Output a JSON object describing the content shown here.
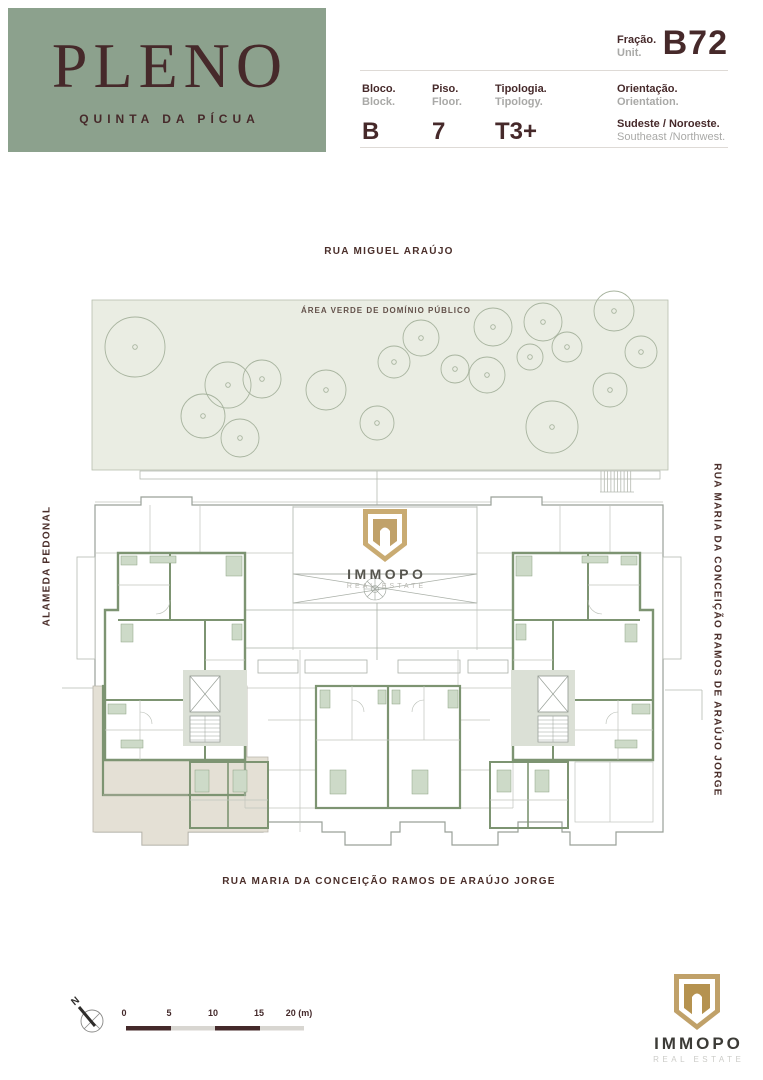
{
  "brand": {
    "name": "PLENO",
    "subtitle": "QUINTA DA PÍCUA"
  },
  "unit_info": {
    "fraction_label_pt": "Fração.",
    "fraction_label_en": "Unit.",
    "fraction_value": "B72",
    "fields": [
      {
        "label_pt": "Bloco.",
        "label_en": "Block.",
        "value": "B"
      },
      {
        "label_pt": "Piso.",
        "label_en": "Floor.",
        "value": "7"
      },
      {
        "label_pt": "Tipologia.",
        "label_en": "Tipology.",
        "value": "T3+"
      },
      {
        "label_pt": "Orientação.",
        "label_en": "Orientation.",
        "value": "Sudeste / Noroeste.",
        "value_en": "Southeast /Northwest."
      }
    ]
  },
  "site_plan": {
    "street_top": "RUA MIGUEL ARAÚJO",
    "street_left": "ALAMEDA PEDONAL",
    "street_right": "RUA MARIA DA CONCEIÇÃO RAMOS DE ARAÚJO JORGE",
    "street_bottom": "RUA MARIA DA CONCEIÇÃO RAMOS DE ARAÚJO JORGE",
    "green_area_label": "ÁREA VERDE DE DOMÍNIO PÚBLICO",
    "highlighted_unit": "B72",
    "watermark": {
      "name": "IMMOPO",
      "tagline": "REAL ESTATE"
    },
    "trees": [
      {
        "x": 135,
        "y": 347,
        "r": 30
      },
      {
        "x": 228,
        "y": 385,
        "r": 23
      },
      {
        "x": 203,
        "y": 416,
        "r": 22
      },
      {
        "x": 240,
        "y": 438,
        "r": 19
      },
      {
        "x": 262,
        "y": 379,
        "r": 19
      },
      {
        "x": 326,
        "y": 390,
        "r": 20
      },
      {
        "x": 377,
        "y": 423,
        "r": 17
      },
      {
        "x": 394,
        "y": 362,
        "r": 16
      },
      {
        "x": 421,
        "y": 338,
        "r": 18
      },
      {
        "x": 455,
        "y": 369,
        "r": 14
      },
      {
        "x": 493,
        "y": 327,
        "r": 19
      },
      {
        "x": 487,
        "y": 375,
        "r": 18
      },
      {
        "x": 543,
        "y": 322,
        "r": 19
      },
      {
        "x": 530,
        "y": 357,
        "r": 13
      },
      {
        "x": 567,
        "y": 347,
        "r": 15
      },
      {
        "x": 552,
        "y": 427,
        "r": 26
      },
      {
        "x": 614,
        "y": 311,
        "r": 20
      },
      {
        "x": 641,
        "y": 352,
        "r": 16
      },
      {
        "x": 610,
        "y": 390,
        "r": 17
      }
    ]
  },
  "scale_bar": {
    "labels": [
      "0",
      "5",
      "10",
      "15",
      "20 (m)"
    ]
  },
  "compass": {
    "label": "N"
  },
  "footer": {
    "logo_name": "IMMOPO",
    "logo_tagline": "REAL ESTATE"
  },
  "colors": {
    "brand_green": "#8CA18D",
    "brand_brown": "#46292A",
    "muted_gray": "#A9A9A7",
    "plan_wall_green": "#7D9472",
    "vegetation_fill": "#EAEDE3",
    "highlight_beige": "#E4E0D5",
    "logo_gold": "#C0A169"
  }
}
